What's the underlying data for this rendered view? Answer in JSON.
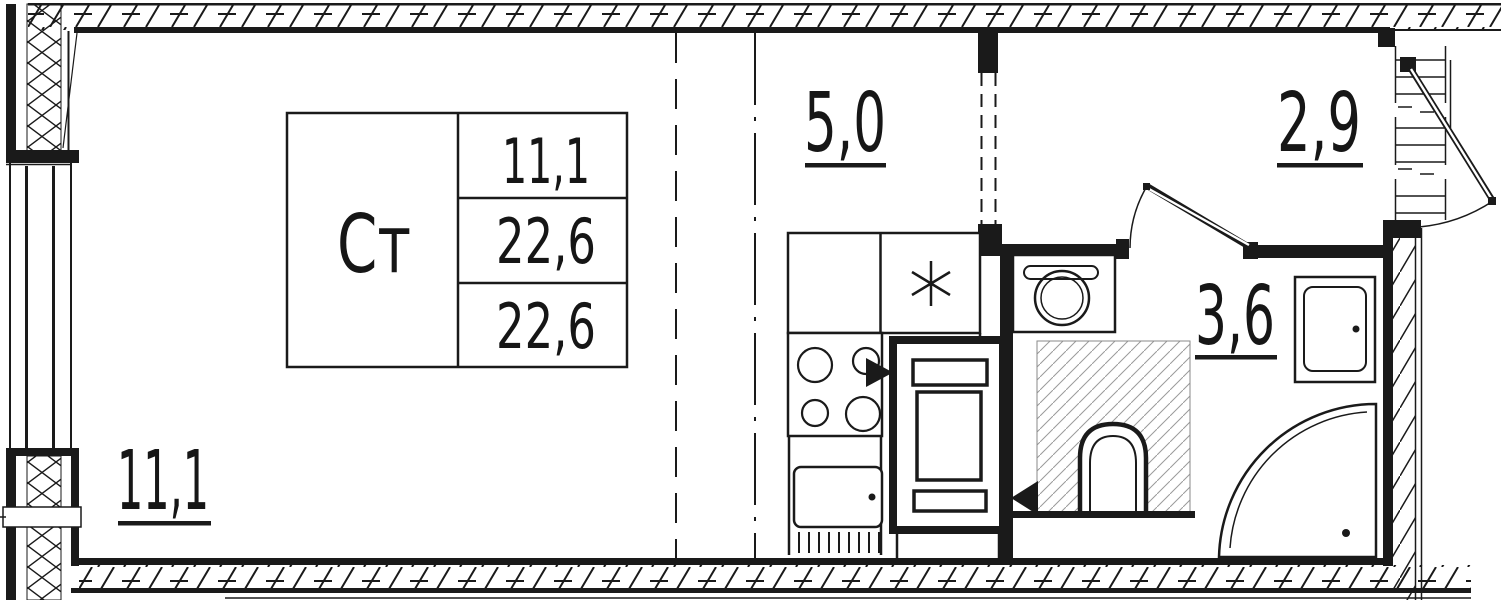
{
  "colors": {
    "ink": "#1a1a1a",
    "paper": "#ffffff",
    "light_hatch": "#8a8a8a"
  },
  "title_block": {
    "unit_type": "Ст",
    "areas": [
      "11,1",
      "22,6",
      "22,6"
    ]
  },
  "room_areas": {
    "living": "11,1",
    "kitchen_niche": "5,0",
    "hallway": "2,9",
    "bathroom": "3,6"
  },
  "symbols": {
    "kitchen_vent": "six-spoke-asterisk",
    "entry_flow_right": "filled-triangle-right",
    "entry_flow_left": "filled-triangle-left",
    "door_swing": "quarter-arc"
  }
}
